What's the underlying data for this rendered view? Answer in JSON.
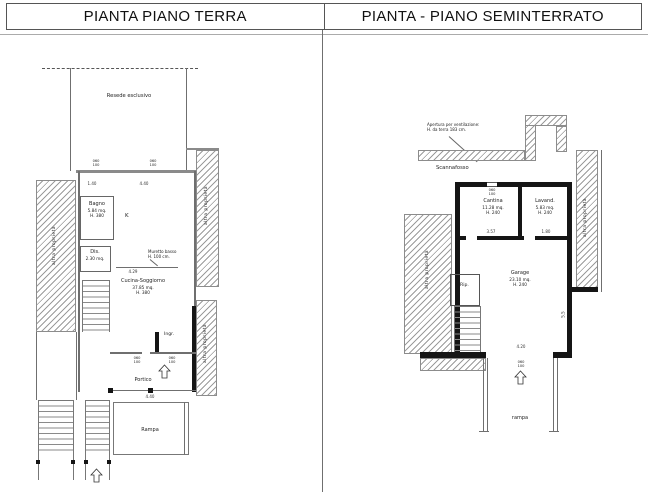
{
  "header": {
    "left_title": "PIANTA PIANO TERRA",
    "right_title": "PIANTA - PIANO SEMINTERRATO"
  },
  "shared": {
    "neighbor_label": "altra proprietà",
    "window_tag_top": "060",
    "window_tag_bottom": "100"
  },
  "ground_floor": {
    "resede_label": "Resede esclusivo",
    "rooms": {
      "bagno": {
        "name": "Bagno",
        "area": "5.84 mq.",
        "height": "H. 380"
      },
      "kitchen_mark": "K",
      "dis": {
        "name": "Dis.",
        "area": "2.30 mq."
      },
      "cucina_soggiorno": {
        "name": "Cucina-Soggiorno",
        "area": "37.85 mq.",
        "height": "H. 380"
      },
      "ingresso": "Ingr.",
      "portico": "Portico",
      "rampa": "Rampa"
    },
    "muretto_note": {
      "line1": "Muretto basso",
      "line2": "H. 100 cm."
    },
    "dims": {
      "top_left": "1.40",
      "top_right": "4.40",
      "muretto": "4.29",
      "rampa_width": "4.40"
    }
  },
  "basement": {
    "vent_note": {
      "line1": "Apertura per ventilazione:",
      "line2": "H. da terra 183 cm."
    },
    "scannafosso_label": "Scannafosso",
    "rooms": {
      "cantina": {
        "name": "Cantina",
        "area": "11.28 mq.",
        "height": "H. 240"
      },
      "lavanderia": {
        "name": "Lavand.",
        "area": "5.83 mq.",
        "height": "H. 240"
      },
      "garage": {
        "name": "Garage",
        "area": "23.10 mq.",
        "height": "H. 240"
      },
      "ripostiglio": "Rip.",
      "rampa": "rampa"
    },
    "dims": {
      "cantina_width": "3.57",
      "lavanderia_width": "1.80",
      "garage_width": "4.20",
      "garage_depth": "5.5"
    }
  }
}
